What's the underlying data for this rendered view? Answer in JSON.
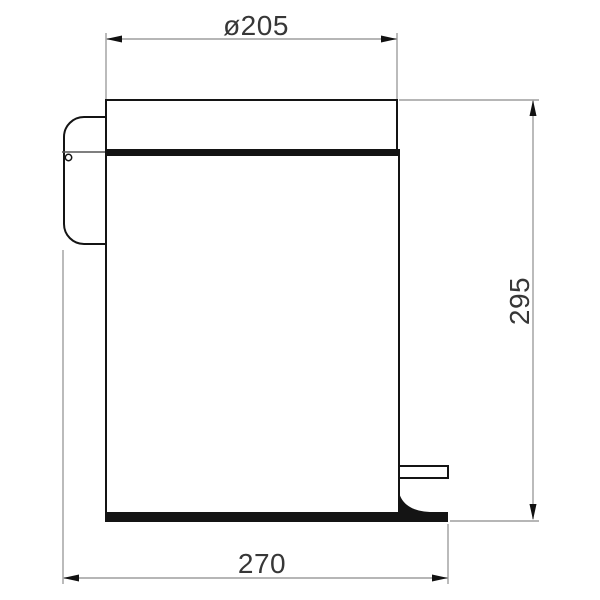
{
  "drawing": {
    "subject": "pedal-bin-side-view",
    "dimensions": {
      "top_diameter": {
        "label": "ø205",
        "value": 205,
        "orientation": "horizontal"
      },
      "right_height": {
        "label": "295",
        "value": 295,
        "orientation": "vertical"
      },
      "bottom_width": {
        "label": "270",
        "value": 270,
        "orientation": "horizontal"
      }
    },
    "colors": {
      "background": "#ffffff",
      "outline": "#141414",
      "dimension_line": "#9e9e9e",
      "arrow": "#111111",
      "text": "#373737"
    }
  }
}
